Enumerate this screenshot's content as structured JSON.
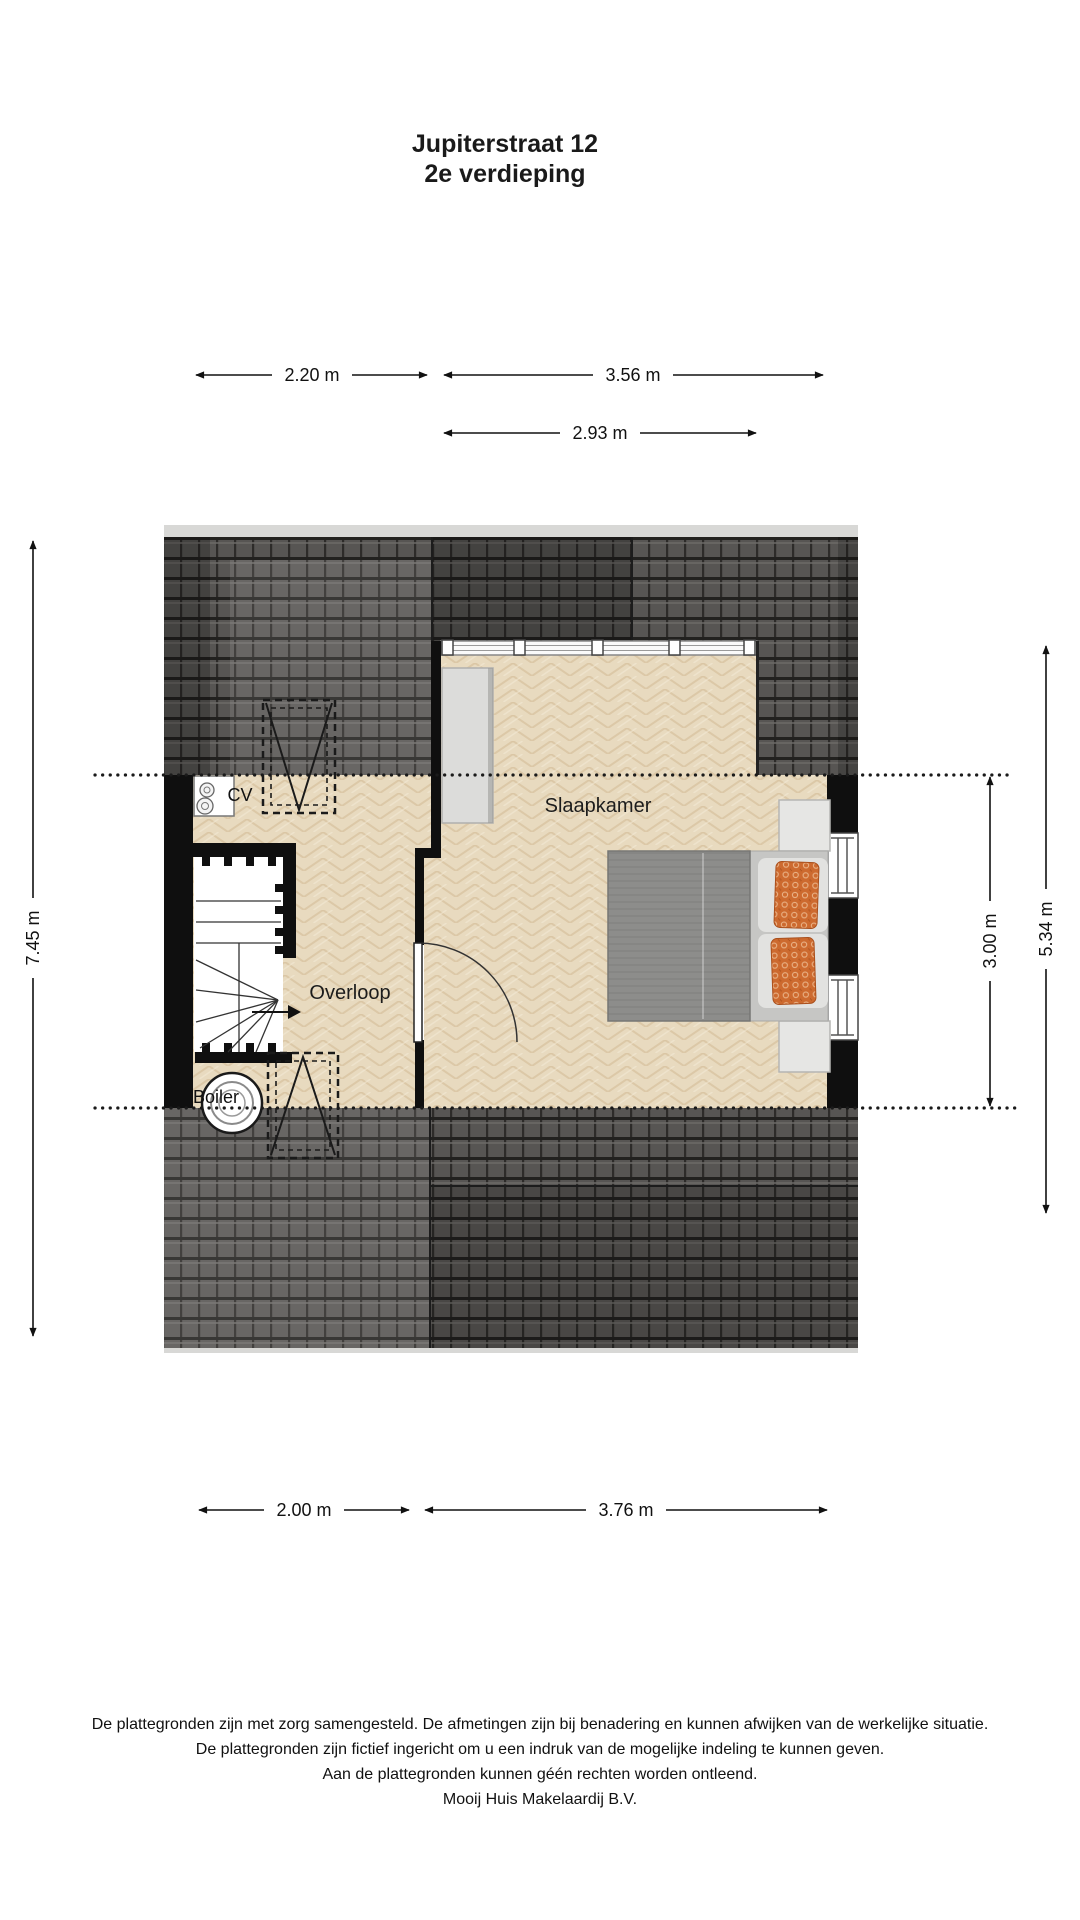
{
  "title": {
    "line1": "Jupiterstraat 12",
    "line2": "2e verdieping"
  },
  "dimensions": {
    "top_left": "2.20 m",
    "top_right": "3.56 m",
    "dormer_width": "2.93 m",
    "left_height": "7.45 m",
    "right_inner_height": "3.00 m",
    "right_outer_height": "5.34 m",
    "bottom_left": "2.00 m",
    "bottom_right": "3.76 m"
  },
  "rooms": {
    "bedroom": "Slaapkamer",
    "landing": "Overloop"
  },
  "fixtures": {
    "cv": "CV",
    "boiler": "Boiler"
  },
  "footer": {
    "line1": "De plattegronden zijn met zorg samengesteld. De afmetingen zijn bij benadering en kunnen afwijken van de werkelijke situatie.",
    "line2": "De plattegronden zijn fictief ingericht om u een indruk van de mogelijke indeling te kunnen geven.",
    "line3": "Aan de plattegronden kunnen géén rechten worden ontleend.",
    "line4": "Mooij Huis Makelaardij B.V."
  },
  "colors": {
    "roof_tile": "#575553",
    "floor_parquet": "#e8dabf",
    "wall": "#0f0f0f",
    "pillow_accent": "#cd6a2f",
    "furniture_grey": "#8d8d8b",
    "light_grey": "#dcdcda"
  }
}
